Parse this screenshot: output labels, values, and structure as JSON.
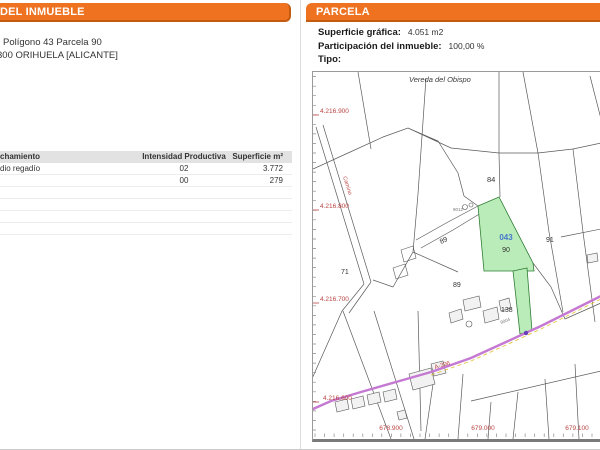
{
  "left_panel": {
    "header": "DEL INMUEBLE",
    "address_line1": "Polígono 43 Parcela 90",
    "address_line2": "300 ORIHUELA [ALICANTE]",
    "table": {
      "headers": [
        "chamiento",
        "Intensidad Productiva",
        "Superficie m²"
      ],
      "rows": [
        {
          "label": "dio regadío",
          "intensidad": "02",
          "superficie": "3.772"
        },
        {
          "label": "",
          "intensidad": "00",
          "superficie": "279"
        }
      ]
    }
  },
  "right_panel": {
    "header": "PARCELA",
    "fields": [
      {
        "label": "Superficie gráfica:",
        "value": "4.051 m2"
      },
      {
        "label": "Participación del inmueble:",
        "value": "100,00 %"
      },
      {
        "label": "Tipo:",
        "value": ""
      }
    ],
    "map": {
      "street_label": "Vereda del Obispo",
      "road_label": "A-396",
      "path_label": "Camino",
      "parcel_ref": "043",
      "coord_y": [
        "4.216.900",
        "4.216.800",
        "4.216.700",
        "4.216.600"
      ],
      "coord_x": [
        "678.900",
        "679.000",
        "679.100"
      ],
      "parcel_numbers": [
        "84",
        "89",
        "90",
        "91",
        "89",
        "138",
        "71"
      ],
      "small_labels": [
        "9012",
        "9004"
      ],
      "colors": {
        "header_orange": "#EE7220",
        "header_border": "#C35B11",
        "highlight_green": "#B9ECB9",
        "highlight_border": "#2F7D32",
        "parcel_ref_blue": "#4877CC",
        "coord_red": "#B94442",
        "road_purple": "#C479D2",
        "road_dash_yellow": "#E3C43C",
        "boundary_gray": "#5A5A5A"
      }
    }
  }
}
